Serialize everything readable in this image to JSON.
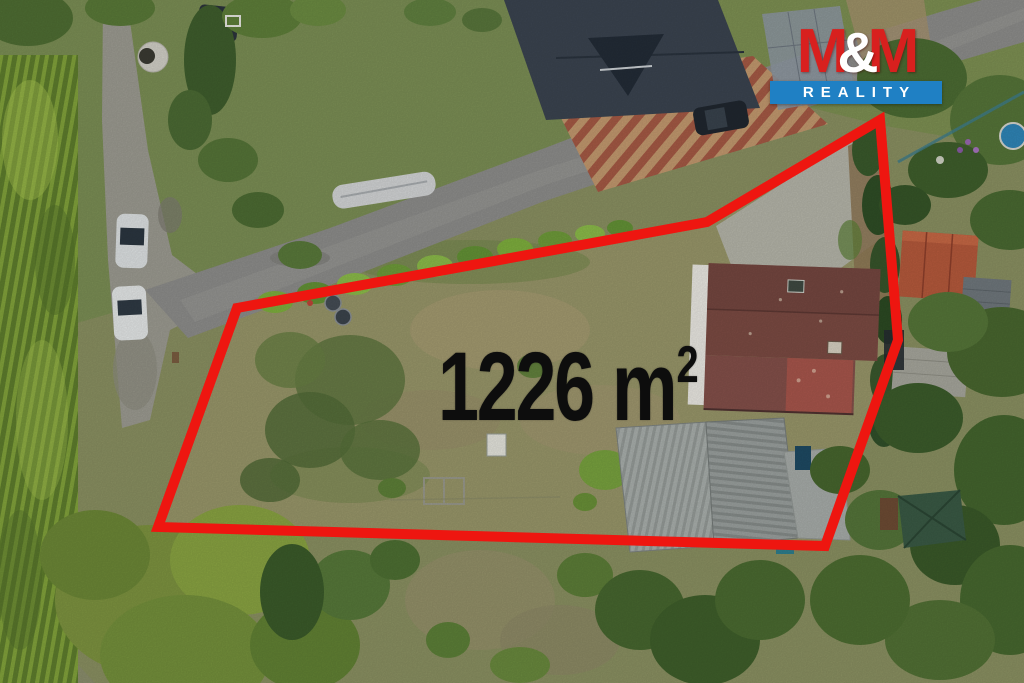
{
  "overlay": {
    "area_value": "1226",
    "area_unit_base": "m",
    "area_unit_exponent": "2",
    "area_label": "1226 m²",
    "text_color": "#0d0d0d",
    "boundary_color": "#ee1610",
    "boundary_points": "237,308 707,222 880,120 898,340 825,546 158,527"
  },
  "logo": {
    "m_left": "M",
    "ampersand": "&",
    "m_right": "M",
    "subtitle": "REALITY",
    "red": "#d8201e",
    "blue": "#1f80c4",
    "white": "#ffffff"
  }
}
